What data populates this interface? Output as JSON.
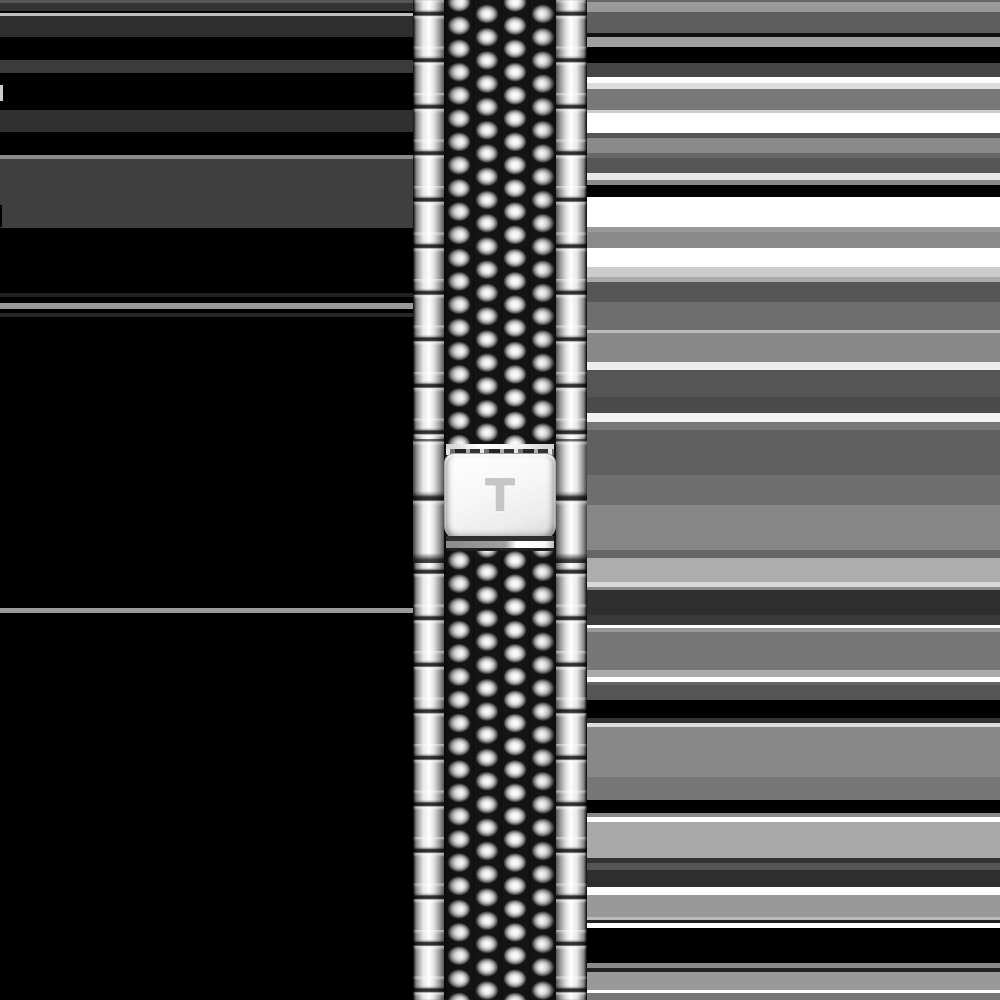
{
  "image": {
    "description": "Product photo of a polished stainless steel beads-of-rice watch bracelet with a butterfly clasp engraved with a T logo, on a black background with horizontal smear bands",
    "background_color": "#000000"
  },
  "clasp": {
    "logo_text": "T",
    "logo_color": "#c6c6c6",
    "plate_color": "#f4f4f4"
  },
  "bracelet": {
    "metal_highlight": "#ffffff",
    "metal_mid": "#bdbdbd",
    "metal_shadow": "#2a2a2a",
    "link_pitch_px": 46.5,
    "bead_row_pitch_px": 23.25
  },
  "background": {
    "left": {
      "base": "#000000",
      "bands": [
        {
          "y": 0,
          "h": 3,
          "c": "#565656"
        },
        {
          "y": 3,
          "h": 8,
          "c": "#333333"
        },
        {
          "y": 13,
          "h": 3,
          "c": "#bdbdbd"
        },
        {
          "y": 16,
          "h": 21,
          "c": "#2e2e2e"
        },
        {
          "y": 60,
          "h": 13,
          "c": "#3b3b3b"
        },
        {
          "y": 85,
          "h": 16,
          "c": "#cccccc",
          "x": 0,
          "w": 3
        },
        {
          "y": 110,
          "h": 22,
          "c": "#303030"
        },
        {
          "y": 155,
          "h": 4,
          "c": "#8a8a8a"
        },
        {
          "y": 159,
          "h": 69,
          "c": "#3f3f3f"
        },
        {
          "y": 205,
          "h": 22,
          "c": "#000000",
          "x": 0,
          "w": 2
        },
        {
          "y": 293,
          "h": 4,
          "c": "#202020"
        },
        {
          "y": 303,
          "h": 6,
          "c": "#9a9a9a"
        },
        {
          "y": 313,
          "h": 4,
          "c": "#262626"
        },
        {
          "y": 608,
          "h": 5,
          "c": "#9a9a9a"
        }
      ]
    },
    "right": {
      "base": "#000000",
      "bands": [
        {
          "y": 0,
          "h": 2,
          "c": "#666666"
        },
        {
          "y": 2,
          "h": 10,
          "c": "#999999"
        },
        {
          "y": 12,
          "h": 21,
          "c": "#5e5e5e"
        },
        {
          "y": 33,
          "h": 4,
          "c": "#111111"
        },
        {
          "y": 37,
          "h": 10,
          "c": "#a0a0a0"
        },
        {
          "y": 47,
          "h": 16,
          "c": "#000000"
        },
        {
          "y": 63,
          "h": 14,
          "c": "#454545"
        },
        {
          "y": 77,
          "h": 6,
          "c": "#ffffff"
        },
        {
          "y": 83,
          "h": 6,
          "c": "#dddddd"
        },
        {
          "y": 89,
          "h": 21,
          "c": "#787878"
        },
        {
          "y": 110,
          "h": 3,
          "c": "#cccccc"
        },
        {
          "y": 113,
          "h": 20,
          "c": "#ffffff"
        },
        {
          "y": 133,
          "h": 5,
          "c": "#555555"
        },
        {
          "y": 138,
          "h": 15,
          "c": "#8a8a8a"
        },
        {
          "y": 153,
          "h": 5,
          "c": "#696969"
        },
        {
          "y": 158,
          "h": 15,
          "c": "#565656"
        },
        {
          "y": 173,
          "h": 7,
          "c": "#e8e8e8"
        },
        {
          "y": 180,
          "h": 5,
          "c": "#8a8a8a"
        },
        {
          "y": 185,
          "h": 12,
          "c": "#000000"
        },
        {
          "y": 197,
          "h": 30,
          "c": "#ffffff"
        },
        {
          "y": 227,
          "h": 5,
          "c": "#999999"
        },
        {
          "y": 232,
          "h": 16,
          "c": "#8a8a8a"
        },
        {
          "y": 248,
          "h": 19,
          "c": "#ffffff"
        },
        {
          "y": 267,
          "h": 10,
          "c": "#cccccc"
        },
        {
          "y": 277,
          "h": 5,
          "c": "#aaaaaa"
        },
        {
          "y": 282,
          "h": 20,
          "c": "#565656"
        },
        {
          "y": 302,
          "h": 28,
          "c": "#6e6e6e"
        },
        {
          "y": 330,
          "h": 3,
          "c": "#bbbbbb"
        },
        {
          "y": 333,
          "h": 29,
          "c": "#888888"
        },
        {
          "y": 362,
          "h": 8,
          "c": "#eeeeee"
        },
        {
          "y": 370,
          "h": 27,
          "c": "#555555"
        },
        {
          "y": 397,
          "h": 16,
          "c": "#4a4a4a"
        },
        {
          "y": 413,
          "h": 9,
          "c": "#f2f2f2"
        },
        {
          "y": 422,
          "h": 8,
          "c": "#777777"
        },
        {
          "y": 430,
          "h": 45,
          "c": "#606060"
        },
        {
          "y": 475,
          "h": 30,
          "c": "#6e6e6e"
        },
        {
          "y": 505,
          "h": 45,
          "c": "#868686"
        },
        {
          "y": 550,
          "h": 8,
          "c": "#666666"
        },
        {
          "y": 558,
          "h": 24,
          "c": "#adadad"
        },
        {
          "y": 582,
          "h": 5,
          "c": "#d8d8d8"
        },
        {
          "y": 587,
          "h": 3,
          "c": "#888888"
        },
        {
          "y": 590,
          "h": 25,
          "c": "#2e2e2e"
        },
        {
          "y": 615,
          "h": 10,
          "c": "#3a3a3a"
        },
        {
          "y": 625,
          "h": 3,
          "c": "#ffffff"
        },
        {
          "y": 628,
          "h": 4,
          "c": "#999999"
        },
        {
          "y": 632,
          "h": 38,
          "c": "#777777"
        },
        {
          "y": 670,
          "h": 7,
          "c": "#aaaaaa"
        },
        {
          "y": 677,
          "h": 5,
          "c": "#ffffff"
        },
        {
          "y": 682,
          "h": 3,
          "c": "#666666"
        },
        {
          "y": 685,
          "h": 15,
          "c": "#555555"
        },
        {
          "y": 700,
          "h": 18,
          "c": "#000000"
        },
        {
          "y": 718,
          "h": 5,
          "c": "#333333"
        },
        {
          "y": 723,
          "h": 4,
          "c": "#dddddd"
        },
        {
          "y": 727,
          "h": 50,
          "c": "#888888"
        },
        {
          "y": 777,
          "h": 23,
          "c": "#777777"
        },
        {
          "y": 800,
          "h": 13,
          "c": "#000000"
        },
        {
          "y": 813,
          "h": 4,
          "c": "#888888"
        },
        {
          "y": 817,
          "h": 5,
          "c": "#ffffff"
        },
        {
          "y": 822,
          "h": 36,
          "c": "#a8a8a8"
        },
        {
          "y": 858,
          "h": 5,
          "c": "#333333"
        },
        {
          "y": 863,
          "h": 7,
          "c": "#555555"
        },
        {
          "y": 870,
          "h": 17,
          "c": "#2e2e2e"
        },
        {
          "y": 887,
          "h": 8,
          "c": "#ffffff"
        },
        {
          "y": 895,
          "h": 22,
          "c": "#999999"
        },
        {
          "y": 917,
          "h": 3,
          "c": "#bbbbbb"
        },
        {
          "y": 920,
          "h": 3,
          "c": "#222222"
        },
        {
          "y": 923,
          "h": 5,
          "c": "#ffffff"
        },
        {
          "y": 928,
          "h": 35,
          "c": "#000000"
        },
        {
          "y": 963,
          "h": 5,
          "c": "#888888"
        },
        {
          "y": 968,
          "h": 4,
          "c": "#222222"
        },
        {
          "y": 972,
          "h": 18,
          "c": "#999999"
        },
        {
          "y": 990,
          "h": 3,
          "c": "#ffffff"
        },
        {
          "y": 993,
          "h": 7,
          "c": "#777777"
        }
      ]
    }
  }
}
